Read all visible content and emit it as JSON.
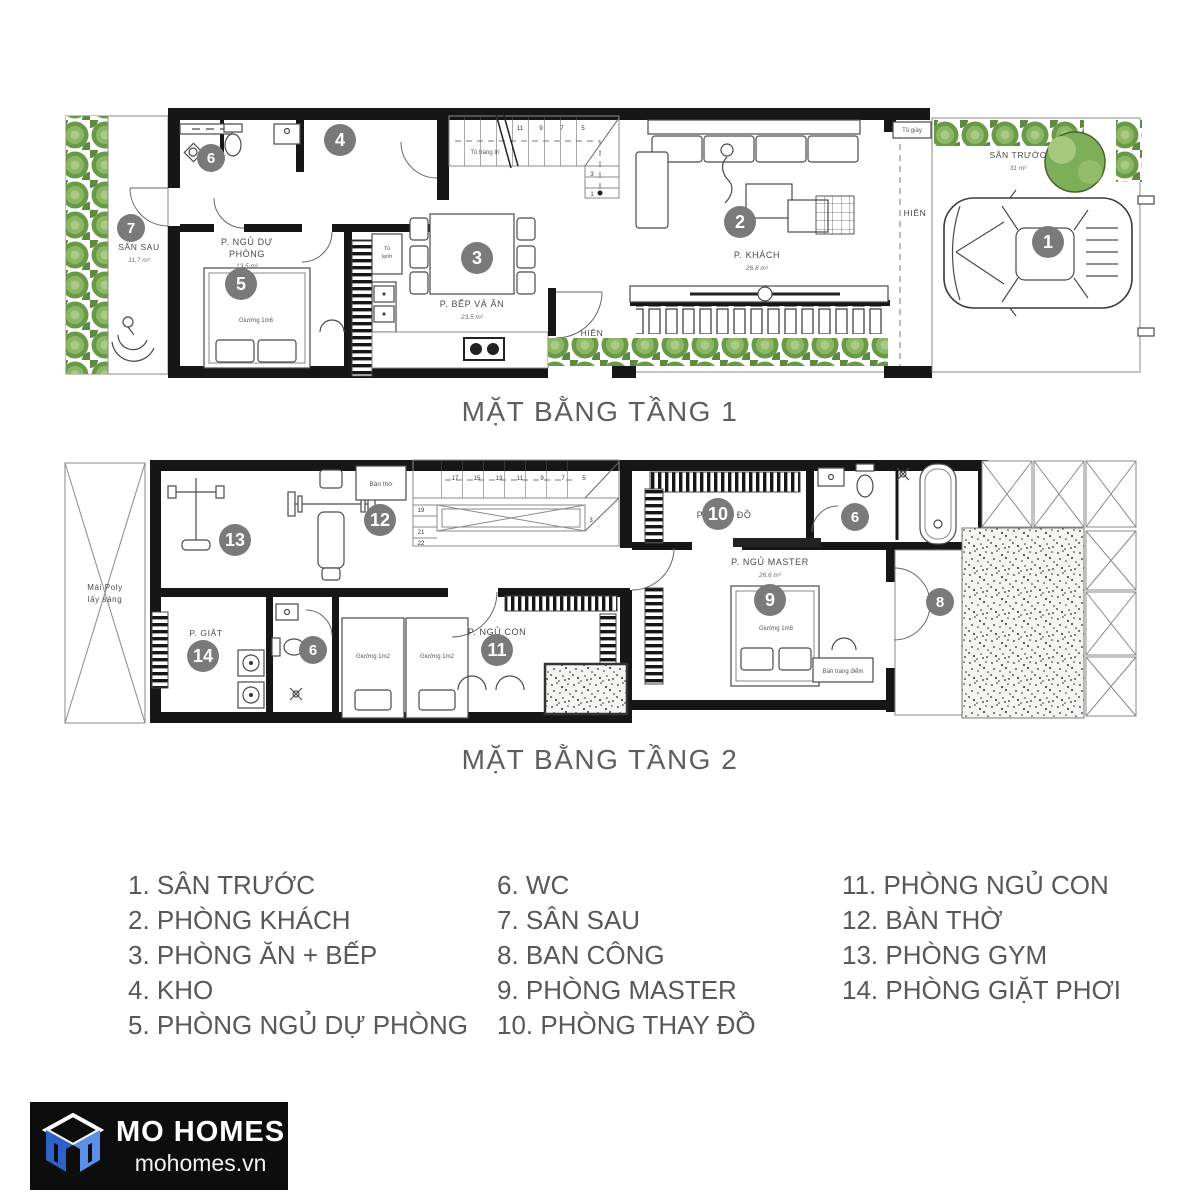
{
  "sheet": {
    "background": "#ffffff"
  },
  "colors": {
    "marker_circle": "#7a7a7a",
    "marker_number": "#ffffff",
    "wall": "#161616",
    "label_text": "#4a4a4a",
    "title_text": "#5e5e5e",
    "plant_green": "#6a9a48",
    "logo_bg": "#0d0d0d",
    "logo_blue": "#4b86e0",
    "logo_text": "#ffffff"
  },
  "floor1": {
    "title": "MẶT BẰNG TẦNG 1",
    "rooms": {
      "san_truoc": {
        "label": "SÂN TRƯỚC",
        "area": "31 m²",
        "marker": "1"
      },
      "khach": {
        "label": "P. KHÁCH",
        "area": "26,8 m²",
        "marker": "2"
      },
      "bep_va_an": {
        "label": "P. BẾP VÀ ĂN",
        "area": "23,5 m²",
        "marker": "3"
      },
      "kho": {
        "marker": "4"
      },
      "ngu_du_phong": {
        "label_line1": "P. NGỦ DỰ",
        "label_line2": "PHÒNG",
        "area": "13,5 m²",
        "marker": "5"
      },
      "wc": {
        "marker": "6"
      },
      "san_sau": {
        "label": "SÂN SAU",
        "area": "11,7 m²",
        "marker": "7"
      }
    },
    "labels": {
      "hien_side": "HIÊN",
      "hien_front": "HIÊN",
      "tu_giay": "Tủ giày",
      "tu_lanh_1": "Tủ",
      "tu_lanh_2": "lạnh",
      "tu_trang_tri": "Tủ trang trí",
      "giuong_1m6": "Giường 1m6"
    },
    "stairs": [
      "1",
      "3",
      "5",
      "7",
      "9",
      "11"
    ]
  },
  "floor2": {
    "title": "MẶT BẰNG TẦNG 2",
    "rooms": {
      "thay_do": {
        "label": "P. THAY ĐỒ",
        "marker": "10"
      },
      "ngu_master": {
        "label": "P. NGỦ MASTER",
        "area": "26,6 m²",
        "marker": "9"
      },
      "ngu_con": {
        "label": "P. NGỦ CON",
        "marker": "11"
      },
      "giat": {
        "label": "P. GIẶT",
        "marker": "14"
      },
      "gym": {
        "marker": "13"
      },
      "ban_tho": {
        "label": "Bàn thờ",
        "marker": "12"
      },
      "wc_small": {
        "marker": "6"
      },
      "wc_master": {
        "marker": "6"
      },
      "ban_cong": {
        "marker": "8"
      }
    },
    "labels": {
      "mai_poly_1": "Mái Poly",
      "mai_poly_2": "lấy sáng",
      "giuong_1m2_a": "Giường 1m2",
      "giuong_1m2_b": "Giường 1m2",
      "giuong_1m8": "Giường 1m8",
      "ban_trang_diem": "Bàn trang điểm"
    },
    "stairs": [
      "3",
      "5",
      "7",
      "9",
      "11",
      "13",
      "15",
      "17",
      "19",
      "21",
      "22"
    ]
  },
  "legend": {
    "items": [
      {
        "number": "1.",
        "label": "SÂN TRƯỚC"
      },
      {
        "number": "2.",
        "label": "PHÒNG KHÁCH"
      },
      {
        "number": "3.",
        "label": "PHÒNG ĂN + BẾP"
      },
      {
        "number": "4.",
        "label": "KHO"
      },
      {
        "number": "5.",
        "label": "PHÒNG NGỦ DỰ PHÒNG"
      },
      {
        "number": "6.",
        "label": "WC"
      },
      {
        "number": "7.",
        "label": "SÂN SAU"
      },
      {
        "number": "8.",
        "label": "BAN CÔNG"
      },
      {
        "number": "9.",
        "label": "PHÒNG MASTER"
      },
      {
        "number": "10.",
        "label": "PHÒNG THAY ĐỒ"
      },
      {
        "number": "11.",
        "label": "PHÒNG NGỦ CON"
      },
      {
        "number": "12.",
        "label": "BÀN THỜ"
      },
      {
        "number": "13.",
        "label": "PHÒNG GYM"
      },
      {
        "number": "14.",
        "label": "PHÒNG GIẶT PHƠI"
      }
    ]
  },
  "logo": {
    "name": "MO HOMES",
    "website": "mohomes.vn"
  }
}
